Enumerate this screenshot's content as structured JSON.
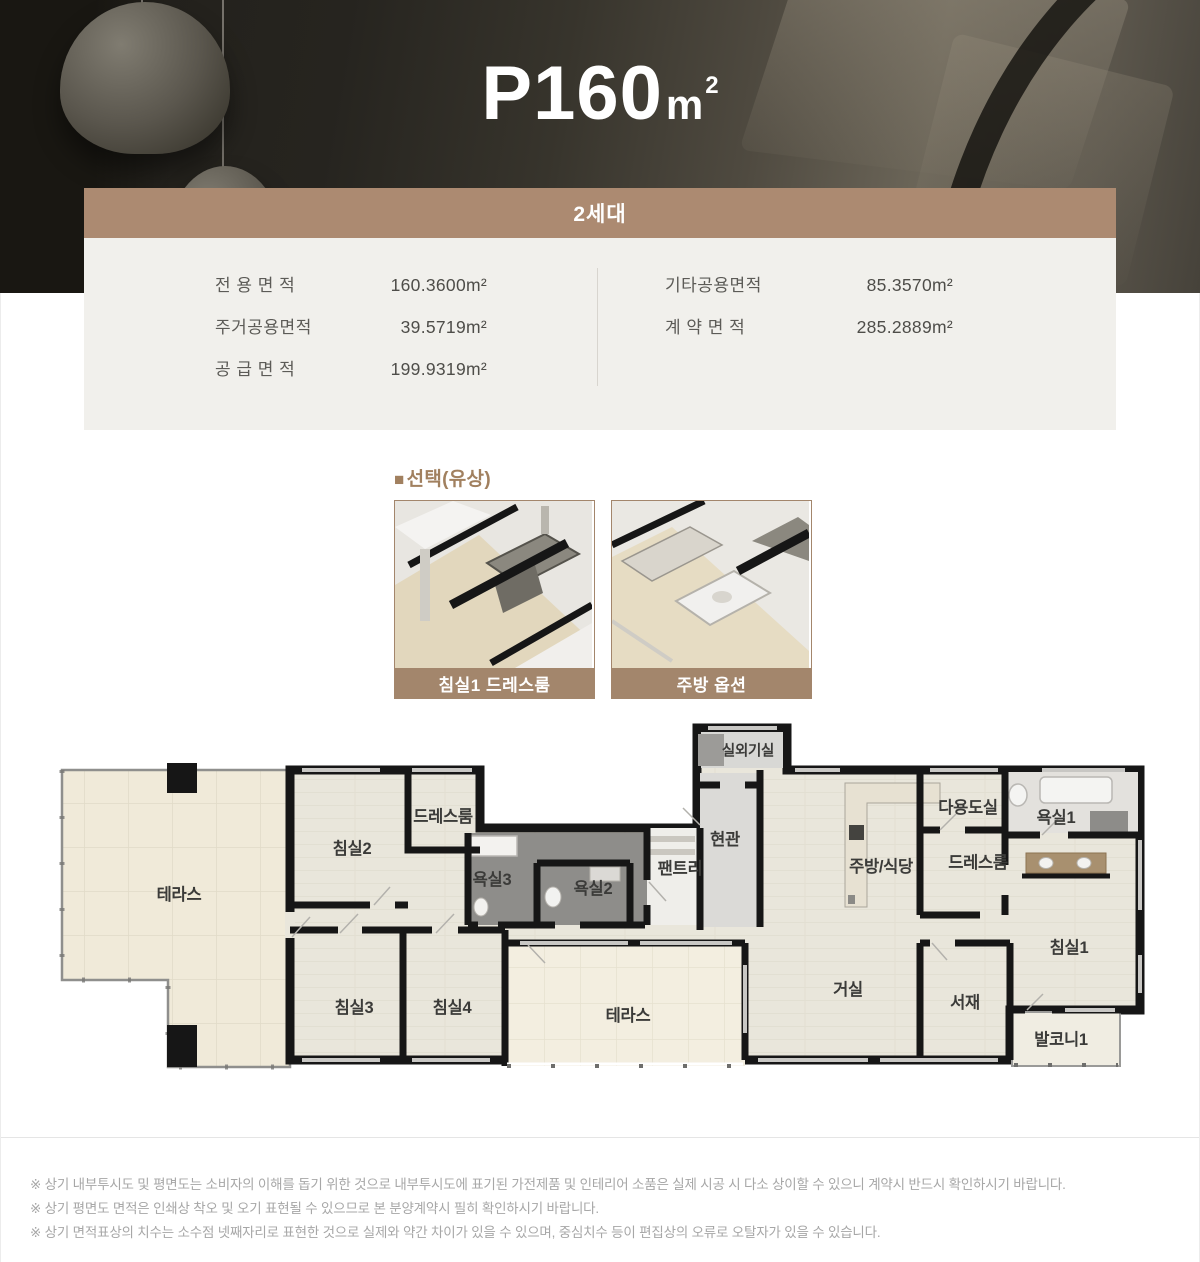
{
  "hero": {
    "title_main": "P160",
    "unit_base": "m",
    "unit_sup": "2"
  },
  "card": {
    "header": "2세대",
    "left": [
      {
        "label": "전 용 면 적",
        "value": "160.3600m²"
      },
      {
        "label": "주거공용면적",
        "value": "39.5719m²"
      },
      {
        "label": "공 급 면 적",
        "value": "199.9319m²"
      }
    ],
    "right": [
      {
        "label": "기타공용면적",
        "value": "85.3570m²"
      },
      {
        "label": "계 약 면 적",
        "value": "285.2889m²"
      }
    ]
  },
  "options": {
    "bullet": "■",
    "title": "선택(유상)",
    "thumbnails": [
      {
        "caption": "침실1 드레스룸"
      },
      {
        "caption": "주방 옵션"
      }
    ]
  },
  "floorplan": {
    "rooms": [
      {
        "label": "테라스",
        "x": 139,
        "y": 178
      },
      {
        "label": "침실2",
        "x": 312,
        "y": 132
      },
      {
        "label": "드레스룸",
        "x": 403,
        "y": 100
      },
      {
        "label": "욕실3",
        "x": 452,
        "y": 163
      },
      {
        "label": "욕실2",
        "x": 553,
        "y": 172
      },
      {
        "label": "팬트리",
        "x": 640,
        "y": 152
      },
      {
        "label": "현관",
        "x": 685,
        "y": 123
      },
      {
        "label": "실외기실",
        "x": 708,
        "y": 35,
        "size": 14.5
      },
      {
        "label": "주방/식당",
        "x": 841,
        "y": 150
      },
      {
        "label": "다용도실",
        "x": 928,
        "y": 91
      },
      {
        "label": "욕실1",
        "x": 1016,
        "y": 101
      },
      {
        "label": "드레스룸",
        "x": 938,
        "y": 146
      },
      {
        "label": "침실1",
        "x": 1029,
        "y": 231
      },
      {
        "label": "침실3",
        "x": 314,
        "y": 291
      },
      {
        "label": "침실4",
        "x": 412,
        "y": 291
      },
      {
        "label": "테라스",
        "x": 588,
        "y": 299
      },
      {
        "label": "거실",
        "x": 808,
        "y": 273
      },
      {
        "label": "서재",
        "x": 925,
        "y": 286
      },
      {
        "label": "발코니1",
        "x": 1021,
        "y": 323
      }
    ]
  },
  "disclaimer": {
    "lines": [
      "※ 상기 내부투시도 및 평면도는 소비자의 이해를 돕기 위한 것으로 내부투시도에 표기된 가전제품 및 인테리어 소품은 실제 시공 시 다소 상이할 수 있으니 계약시 반드시 확인하시기 바랍니다.",
      "※ 상기 평면도 면적은 인쇄상 착오 및 오기 표현될 수 있으므로 본 분양계약시 필히 확인하시기 바랍니다.",
      "※ 상기 면적표상의 치수는 소수점 넷째자리로 표현한 것으로 실제와 약간 차이가 있을 수 있으며, 중심치수 등이 편집상의 오류로 오탈자가 있을 수 있습니다."
    ]
  },
  "colors": {
    "header_bar": "#ac8a71",
    "caption_bar": "#a3866c",
    "section_title": "#a1805f",
    "card_bg": "#f1f0ec",
    "wall": "#161616",
    "disclaimer_text": "#a7a7a7"
  }
}
